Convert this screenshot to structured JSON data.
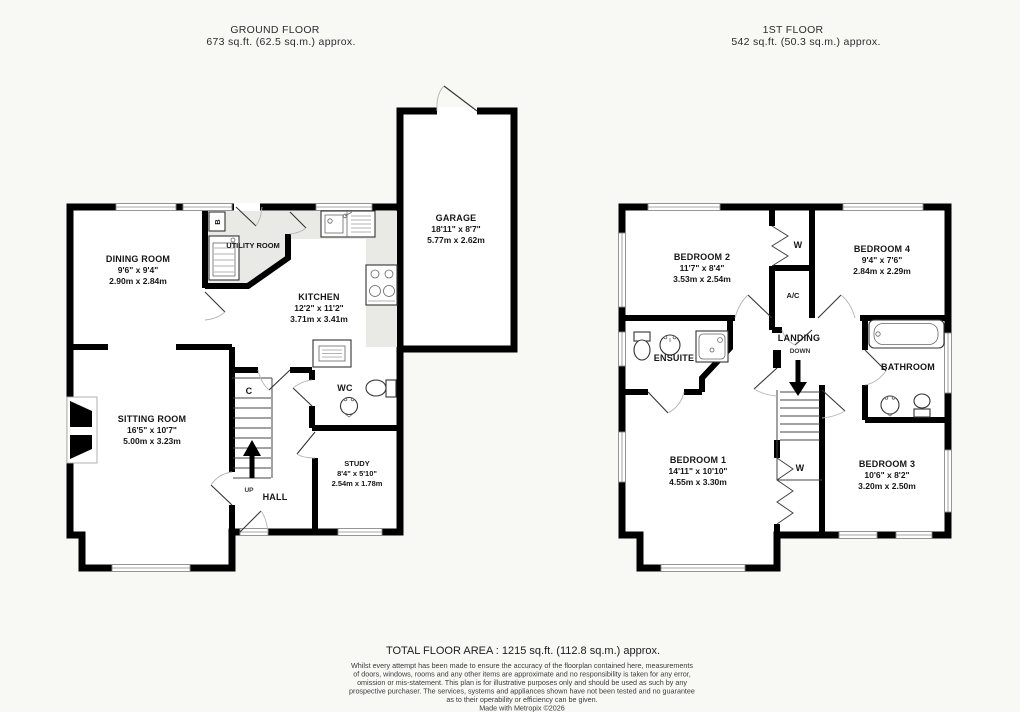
{
  "colors": {
    "wall": "#000000",
    "counter": "#e9e9e6",
    "background": "#f8f8f5"
  },
  "header_ground": {
    "title": "GROUND FLOOR",
    "subtitle": "673 sq.ft. (62.5 sq.m.) approx."
  },
  "header_first": {
    "title": "1ST FLOOR",
    "subtitle": "542 sq.ft. (50.3 sq.m.) approx."
  },
  "ground": {
    "dining": {
      "name": "DINING ROOM",
      "imperial": "9'6\" x 9'4\"",
      "metric": "2.90m x 2.84m"
    },
    "utility": {
      "name": "UTILITY ROOM"
    },
    "kitchen": {
      "name": "KITCHEN",
      "imperial": "12'2\" x 11'2\"",
      "metric": "3.71m x 3.41m"
    },
    "garage": {
      "name": "GARAGE",
      "imperial": "18'11\" x 8'7\"",
      "metric": "5.77m x 2.62m"
    },
    "sitting": {
      "name": "SITTING ROOM",
      "imperial": "16'5\" x 10'7\"",
      "metric": "5.00m x 3.23m"
    },
    "wc": {
      "name": "WC"
    },
    "study": {
      "name": "STUDY",
      "imperial": "8'4\" x 5'10\"",
      "metric": "2.54m x 1.78m"
    },
    "hall": {
      "name": "HALL"
    },
    "up_label": "UP",
    "cupboard_label": "C",
    "boiler_label": "B"
  },
  "first": {
    "bedroom2": {
      "name": "BEDROOM 2",
      "imperial": "11'7\" x 8'4\"",
      "metric": "3.53m x 2.54m"
    },
    "bedroom4": {
      "name": "BEDROOM 4",
      "imperial": "9'4\" x 7'6\"",
      "metric": "2.84m x 2.29m"
    },
    "bedroom1": {
      "name": "BEDROOM 1",
      "imperial": "14'11\" x 10'10\"",
      "metric": "4.55m x 3.30m"
    },
    "bedroom3": {
      "name": "BEDROOM 3",
      "imperial": "10'6\" x 8'2\"",
      "metric": "3.20m x 2.50m"
    },
    "ensuite": {
      "name": "ENSUITE"
    },
    "bathroom": {
      "name": "BATHROOM"
    },
    "landing": {
      "name": "LANDING",
      "direction": "DOWN"
    },
    "airing_label": "A/C",
    "wardrobe_top_label": "W",
    "wardrobe_bottom_label": "W"
  },
  "footer": {
    "total": "TOTAL FLOOR AREA : 1215 sq.ft. (112.8 sq.m.) approx.",
    "disclaimer": [
      "Whilst every attempt has been made to ensure the accuracy of the floorplan contained here, measurements",
      "of doors, windows, rooms and any other items are approximate and no responsibility is taken for any error,",
      "omission or mis-statement. This plan is for illustrative purposes only and should be used as such by any",
      "prospective purchaser. The services, systems and appliances shown have not been tested and no guarantee",
      "as to their operability or efficiency can be given."
    ],
    "credit": "Made with Metropix ©2026"
  }
}
